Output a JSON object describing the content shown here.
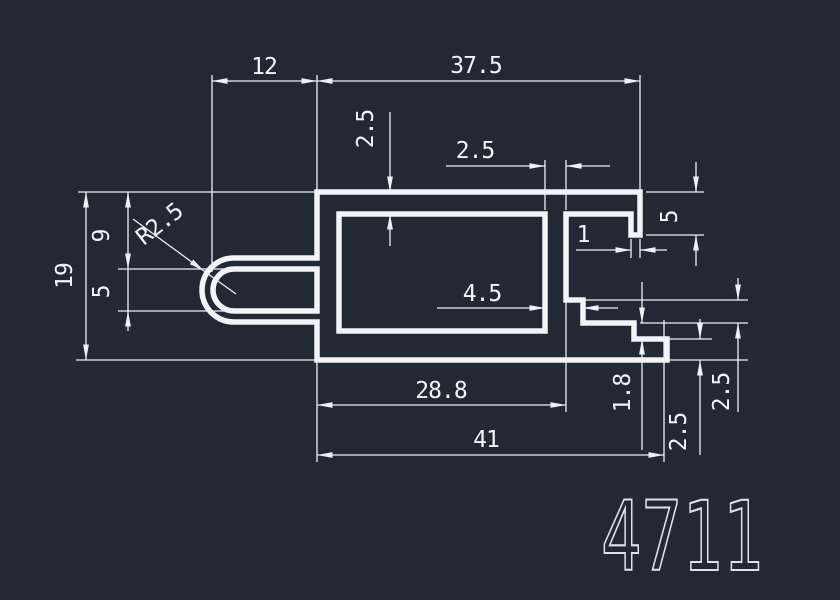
{
  "drawing": {
    "title": "extrusion-profile-cross-section",
    "part_number": "4711",
    "colors": {
      "background": "#222935",
      "lines": "#f2f4f6",
      "part_number_text": "#dde2e8"
    },
    "dimensions": {
      "width_left_arm": "12",
      "width_top": "37.5",
      "wall_top_thickness": "2.5",
      "wall_right_upper": "2.5",
      "hook_depth": "5",
      "hook_lip_width": "1",
      "arm_top_offset": "9",
      "slot_height": "5",
      "height_overall": "19",
      "slot_radius": "R2.5",
      "wall_right_lower": "4.5",
      "width_body": "28.8",
      "width_overall": "41",
      "flange_step": "1.8",
      "flange_thickness": "2.5",
      "step_drop": "2.5"
    }
  }
}
